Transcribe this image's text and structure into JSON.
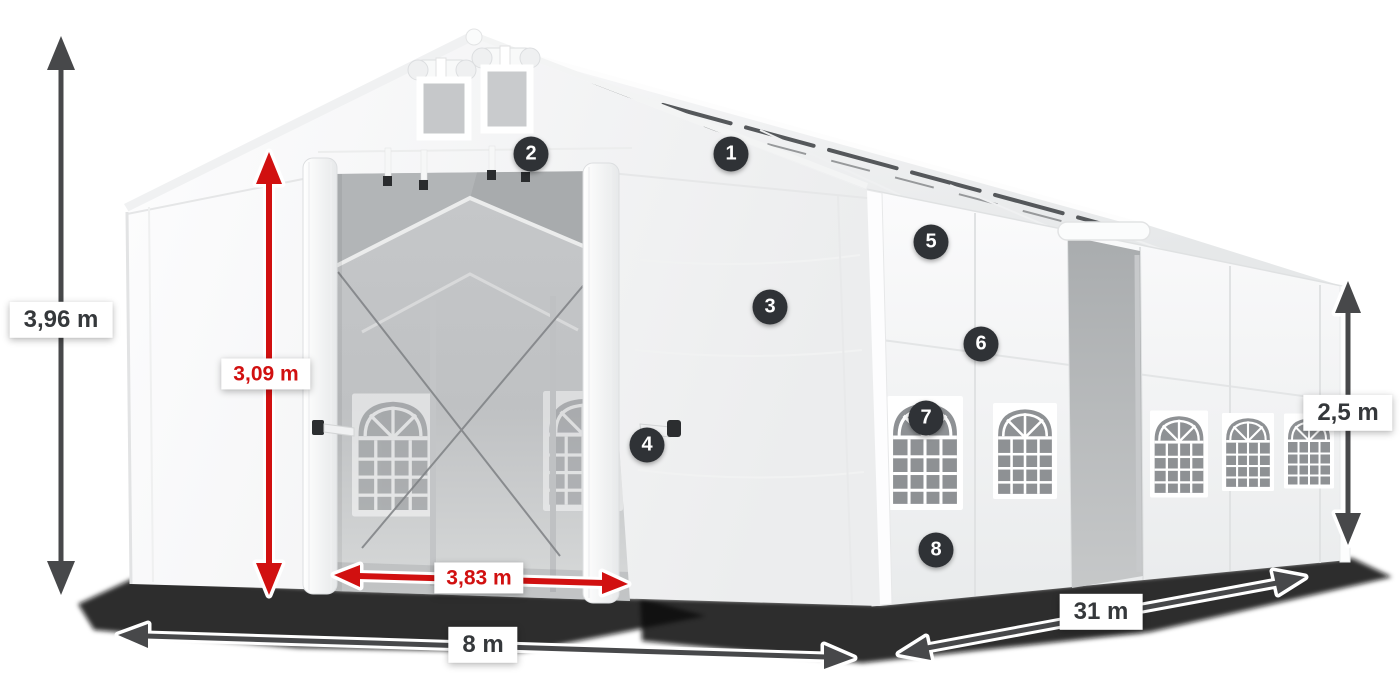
{
  "annotations": {
    "dimensions": [
      {
        "id": "total-height",
        "label": "3,96 m",
        "color": "dark"
      },
      {
        "id": "entrance-height",
        "label": "3,09 m",
        "color": "red"
      },
      {
        "id": "entrance-width",
        "label": "3,83 m",
        "color": "red"
      },
      {
        "id": "gable-width",
        "label": "8 m",
        "color": "dark"
      },
      {
        "id": "length",
        "label": "31 m",
        "color": "dark"
      },
      {
        "id": "side-height",
        "label": "2,5 m",
        "color": "dark"
      }
    ],
    "callouts": [
      {
        "number": "1"
      },
      {
        "number": "2"
      },
      {
        "number": "3"
      },
      {
        "number": "4"
      },
      {
        "number": "5"
      },
      {
        "number": "6"
      },
      {
        "number": "7"
      },
      {
        "number": "8"
      }
    ]
  },
  "colors": {
    "dimension_dark": "#47484a",
    "dimension_red": "#d11010",
    "label_background": "#ffffff",
    "label_text_dark": "#35383b",
    "badge_background": "#2f3236",
    "badge_text": "#ffffff",
    "tent_fabric": "#f4f5f6",
    "interior_gray": "#bfc1c3",
    "background": "#ffffff"
  }
}
